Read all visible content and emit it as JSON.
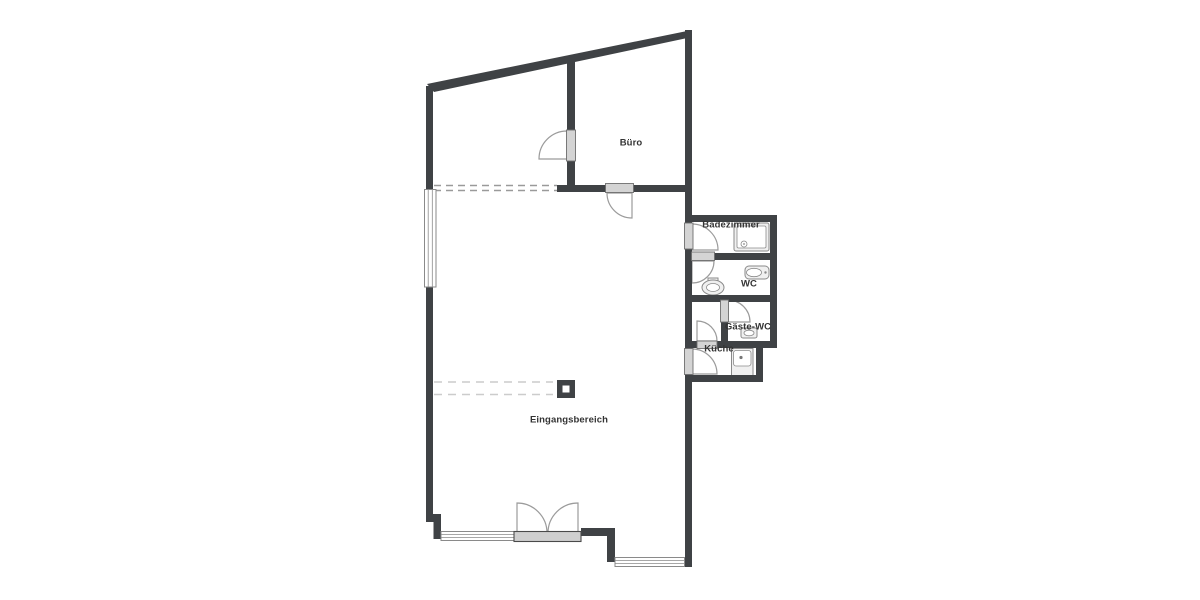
{
  "plan": {
    "type": "floor-plan",
    "language": "de"
  },
  "rooms": [
    {
      "id": "buero",
      "label": "Büro"
    },
    {
      "id": "badezimmer",
      "label": "Badezimmer"
    },
    {
      "id": "wc",
      "label": "WC"
    },
    {
      "id": "gaeste_wc",
      "label": "Gäste-WC"
    },
    {
      "id": "kueche",
      "label": "Küche"
    },
    {
      "id": "eingangsbereich",
      "label": "Eingangsbereich"
    }
  ],
  "fixtures": [
    {
      "id": "shower",
      "room": "Badezimmer"
    },
    {
      "id": "toilet",
      "room": "WC"
    },
    {
      "id": "washbasin",
      "room": "WC"
    },
    {
      "id": "washbasin-small",
      "room": "Gäste-WC"
    },
    {
      "id": "kitchen-sink",
      "room": "Küche"
    }
  ],
  "elements": {
    "windows": 3,
    "single_doors": 7,
    "double_doors": 1,
    "columns": 1
  },
  "colors": {
    "background": "#ffffff",
    "wall": "#3f4245",
    "door_panel": "#d4d4d4",
    "threshold": "#cfcfcf",
    "arc": "#9b9b9b",
    "window_frame": "#8a8a8a",
    "fixture_fill": "#f0f0f0",
    "fixture_stroke": "#8a8a8a",
    "dashed_upper": "#9a9a9a",
    "dashed_lower": "#cccccc",
    "label_text": "#333333"
  }
}
